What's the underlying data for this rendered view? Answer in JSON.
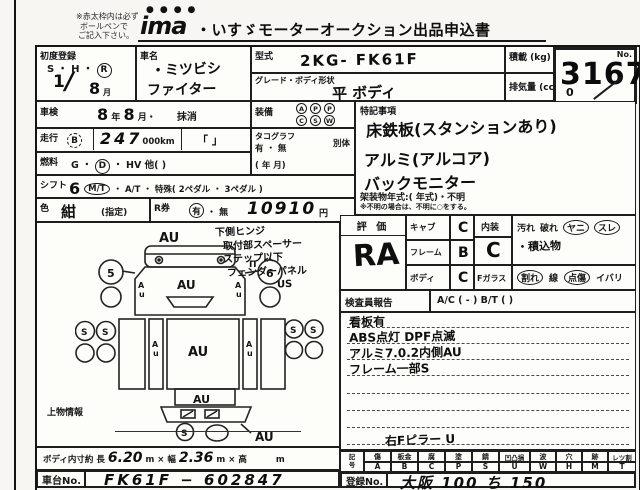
{
  "header": {
    "note1": "※赤太枠内は必ず",
    "note2": "ボールペンで",
    "note3": "ご記入下さい。",
    "logo": "ima",
    "title": "・いすゞモーターオークション出品申込書"
  },
  "top": {
    "first_reg_label": "初度登録",
    "first_reg_eras": "S ・ H ・",
    "first_reg_era_circled": "R",
    "first_reg_year": "1",
    "first_reg_slash": "/",
    "first_reg_month": "8",
    "first_reg_month_unit": "月",
    "car_name_label": "車名",
    "car_name_line1": "・ミツビシ",
    "car_name_line2": "ファイター",
    "model_label": "型式",
    "model_value": "2KG‐ FK61F",
    "grade_label": "グレード・ボディ形状",
    "grade_value": "平 ボディ",
    "payload_label": "積載 (kg)",
    "displacement_label": "排気量 (cc)",
    "no_label": "No.",
    "no_value": "3167",
    "no_scribble": "0"
  },
  "rows": {
    "inspection_label": "車検",
    "inspection_year": "8",
    "inspection_year_unit": "年",
    "inspection_month": "8",
    "inspection_month_unit": "月・",
    "inspection_erased": "抹消",
    "mileage_label": "走行",
    "mileage_grade": "B",
    "mileage_value": "247",
    "mileage_unit": "000km",
    "mileage_brackets": "「  」",
    "fuel_label": "燃料",
    "fuel_g": "G ・",
    "fuel_d": "D",
    "fuel_rest": "・ HV  他(          )",
    "shift_label": "シフト",
    "shift_value": "6",
    "shift_mt": "M/T",
    "shift_rest": "・ A/T ・ 特殊( 2ペダル ・ 3ペダル )",
    "color_label": "色",
    "color_value": "紺",
    "color_designation": "(指定)",
    "rticket_label": "R券",
    "rticket_yes": "有",
    "rticket_mid": "・",
    "rticket_no": "無",
    "rticket_price": "10910",
    "rticket_unit": "円"
  },
  "equipment": {
    "label": "装備",
    "items": [
      {
        "top": "A",
        "bottom": "C"
      },
      {
        "top": "P",
        "bottom": "S"
      },
      {
        "top": "P",
        "bottom": "W"
      }
    ]
  },
  "tachograph": {
    "label": "タコグラフ",
    "options": "有 ・ 無",
    "separate": "別体",
    "date": "(      年      月)"
  },
  "special": {
    "label": "特記事項",
    "lines": [
      "床鉄板(スタンションあり)",
      "アルミ(アルコア)",
      "バックモニター"
    ],
    "body_year": "架装物年式:(            年式)・不明",
    "footnote": "※不明の場合は、不明に○をする。"
  },
  "evaluation": {
    "label": "評 価",
    "overall": "RA",
    "cab_label": "キャブ",
    "cab_value": "C",
    "frame_label": "フレーム",
    "frame_value": "B",
    "body_label": "ボディ",
    "body_value": "C",
    "interior_label": "内装",
    "interior_value": "C",
    "interior_opts": [
      "汚れ",
      "破れ",
      "ヤニ",
      "スレ"
    ],
    "interior_note": "・積込物",
    "fglass_label": "Fガラス",
    "fglass_opts": [
      "割れ",
      "線",
      "点傷",
      "イバリ"
    ]
  },
  "inspector": {
    "label": "検査員報告",
    "ac_bt": "A/C (  -  )   B/T (      )",
    "notes": [
      "看板有",
      "ABS点灯 DPF点滅",
      "アルミ7.0.2内側AU",
      "フレーム一部S"
    ],
    "pillar_note": "右Fピラー U"
  },
  "legend": {
    "symbol_label": "記号",
    "cols": [
      {
        "name": "傷",
        "code": "A"
      },
      {
        "name": "板金",
        "code": "B"
      },
      {
        "name": "腐",
        "code": "C"
      },
      {
        "name": "塗",
        "code": "P"
      },
      {
        "name": "錆",
        "code": "S"
      },
      {
        "name": "凹凸損",
        "code": "U"
      },
      {
        "name": "波",
        "code": "W"
      },
      {
        "name": "穴",
        "code": "H"
      },
      {
        "name": "跡",
        "code": "M"
      },
      {
        "name": "レツ割",
        "code": "T"
      }
    ]
  },
  "registration": {
    "label": "登録No.",
    "value": "大阪 100 ち 150"
  },
  "cargo": {
    "label": "上物情報"
  },
  "dimensions": {
    "label": "ボディ内寸約",
    "length_label": "長",
    "length": "6.20",
    "width_label": "m × 幅",
    "width": "2.36",
    "height_label": "m × 高",
    "height_unit": "m"
  },
  "chassis": {
    "label": "車台No.",
    "value": "FK61F − 602847"
  },
  "diagram": {
    "notes": [
      "下側ヒンジ",
      "取付部スペーサー",
      "ステップ以下",
      "フェンダーパネル",
      "US"
    ],
    "label_au": "AU",
    "label_a": "A",
    "label_u": "u",
    "label_s": "S",
    "mirror_left": "5",
    "mirror_right": "6",
    "pi_mark": "Π"
  }
}
